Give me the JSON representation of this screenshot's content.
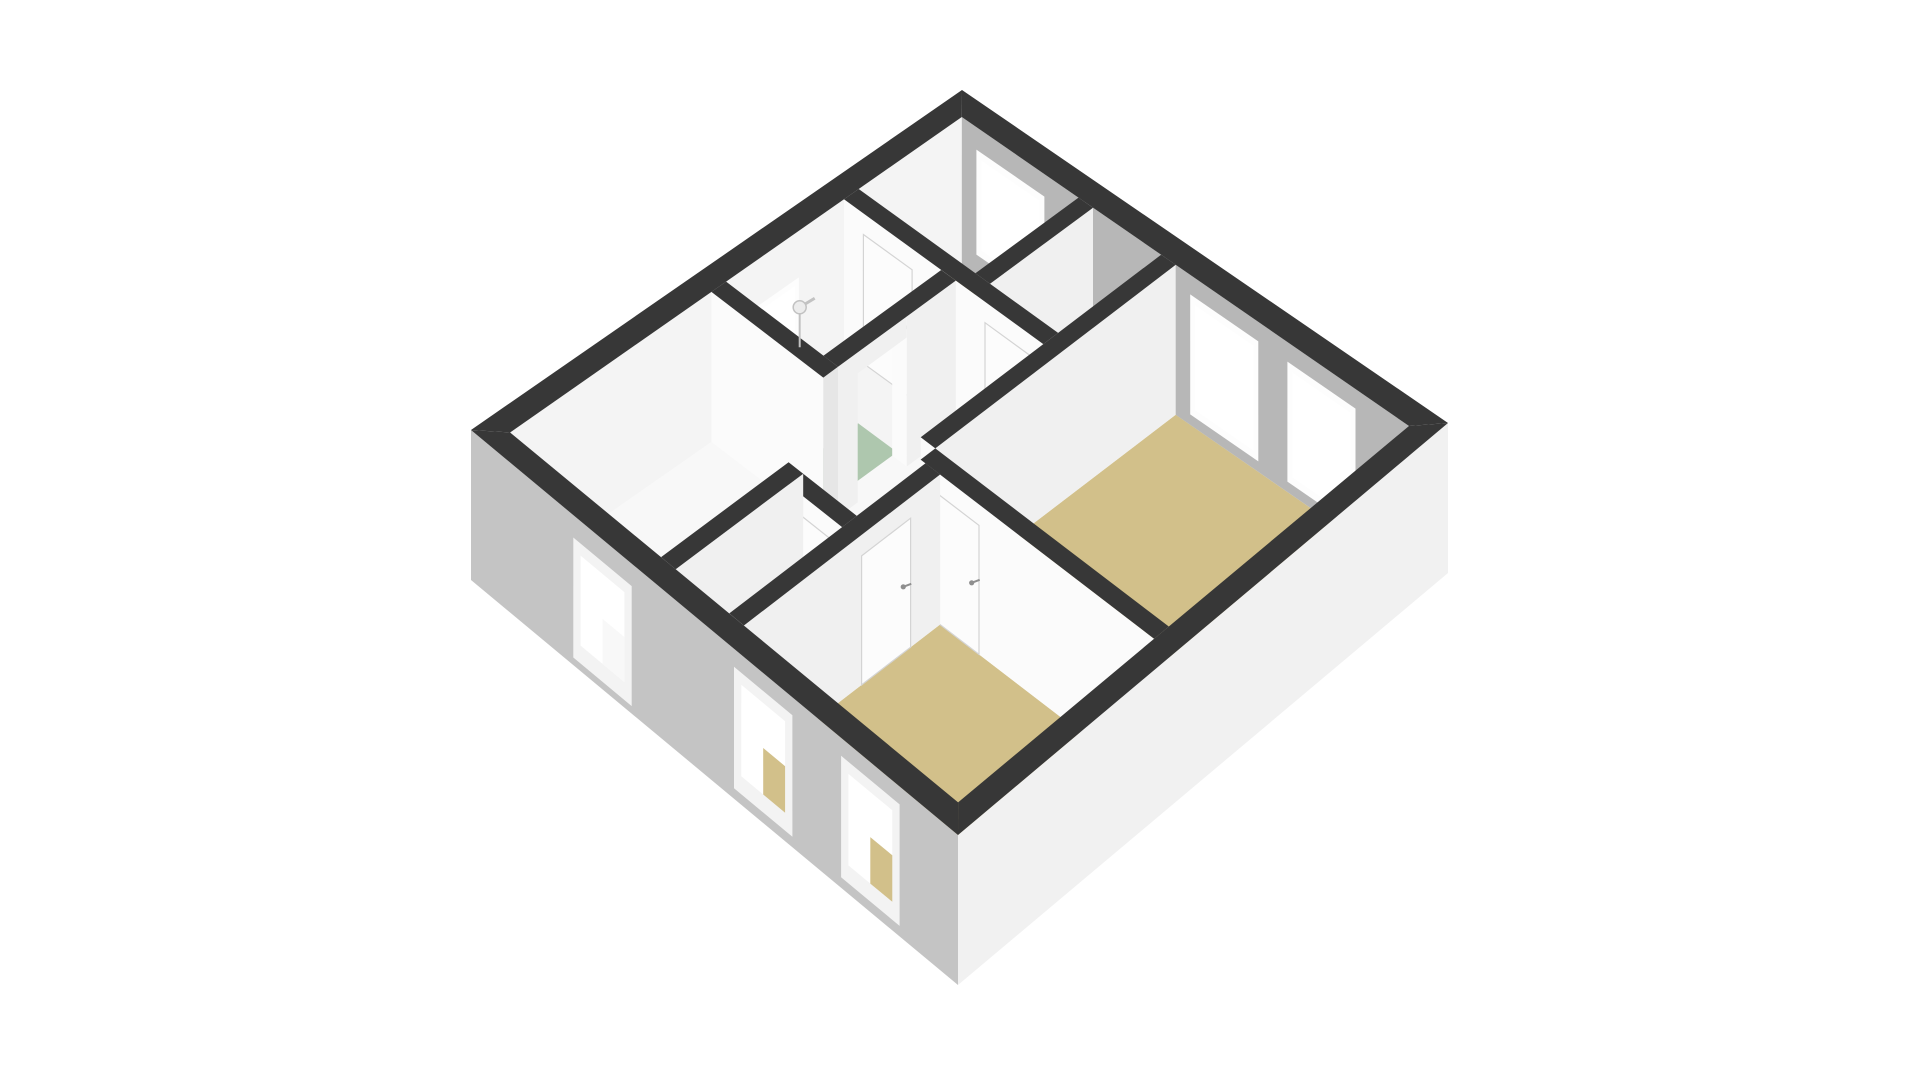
{
  "page": {
    "background": "#ffffff",
    "title": "3D floor plan view"
  },
  "scene": {
    "projection": {
      "corners": {
        "west": [
          471,
          430
        ],
        "north": [
          962,
          90
        ],
        "east": [
          1448,
          423
        ],
        "south": [
          958,
          835
        ]
      },
      "wallHeightPx": 150,
      "planSize": 100,
      "exteriorWallThickness": 4
    },
    "colors": {
      "wallCap": "#373737",
      "swFacade": "#c4c4c4",
      "seFacade": "#f1f1f1",
      "nwInnerFace": "#f4f4f4",
      "neInnerFace": "#b7b7b7",
      "hWallFace": "#fbfbfb",
      "vWallFace": "#f0f0f0",
      "endFace": "#e6e6e6",
      "floorWhite": "#f8f8f8",
      "floorTan": "#d2c08a",
      "floorGreen": "#aec7ae",
      "windowFrame": "#f3f3f3",
      "glass": "#ffffff",
      "doorPanel": "#fcfcfc",
      "doorSeam": "#d4d4d4",
      "handle": "#8f8f8f",
      "fixture": "#c2c2c2"
    },
    "rooms": [
      {
        "name": "floor-slab",
        "floor": "#f8f8f8",
        "rect": [
          4,
          4,
          96,
          96
        ]
      },
      {
        "name": "room-west",
        "floor": "#f8f8f8",
        "rect": [
          4,
          4,
          35,
          45
        ]
      },
      {
        "name": "bathroom",
        "floor": "#f4f4f4",
        "rect": [
          4,
          48,
          24,
          72
        ]
      },
      {
        "name": "bathroom-tile",
        "floor": "#aec7ae",
        "rect": [
          16,
          50,
          24,
          63
        ]
      },
      {
        "name": "bedroom-top",
        "floor": "#d2c08a",
        "rect": [
          4,
          75,
          28,
          96
        ]
      },
      {
        "name": "closet",
        "floor": "#f8f8f8",
        "rect": [
          31,
          75,
          45,
          96
        ]
      },
      {
        "name": "room-east",
        "floor": "#d2c08a",
        "rect": [
          48,
          47,
          96,
          96
        ]
      },
      {
        "name": "room-bottom",
        "floor": "#d2c08a",
        "rect": [
          52,
          4,
          96,
          44
        ]
      },
      {
        "name": "storage",
        "floor": "#f8f8f8",
        "rect": [
          38,
          4,
          49,
          27
        ]
      }
    ],
    "walls": [
      {
        "name": "bathroom-door-wall",
        "rect": [
          24,
          48,
          27,
          72
        ],
        "gap": [
          52,
          62
        ]
      },
      {
        "name": "west-bath-divider",
        "rect": [
          4,
          45,
          27,
          48
        ]
      },
      {
        "name": "hall-north-wall",
        "rect": [
          4,
          72,
          45,
          75
        ],
        "doors": [
          {
            "a1": 8,
            "a2": 18,
            "handle": true
          },
          {
            "a1": 33,
            "a2": 43,
            "handle": false
          }
        ]
      },
      {
        "name": "top-closet-divider",
        "rect": [
          28,
          75,
          31,
          96
        ]
      },
      {
        "name": "east-nw-wall",
        "rect": [
          45,
          47,
          48,
          96
        ]
      },
      {
        "name": "east-sw-wall",
        "rect": [
          48,
          44,
          96,
          47
        ],
        "doors": [
          {
            "a1": 50,
            "a2": 60,
            "handle": true
          }
        ]
      },
      {
        "name": "bottom-nw-wall",
        "rect": [
          49,
          4,
          52,
          44
        ],
        "doors": [
          {
            "a1": 28,
            "a2": 38,
            "handle": true
          }
        ]
      },
      {
        "name": "west-se-wall",
        "rect": [
          35,
          4,
          38,
          30
        ]
      },
      {
        "name": "storage-wall",
        "rect": [
          38,
          27,
          49,
          30
        ],
        "doors": [
          {
            "a1": 40,
            "a2": 47,
            "handle": false
          }
        ]
      }
    ],
    "windows": {
      "nw": [
        {
          "t1": 53,
          "t2": 62,
          "v1": 0.35,
          "v2": 0.66
        }
      ],
      "ne": [
        {
          "t1": 8,
          "t2": 20,
          "v1": 0.2,
          "v2": 0.8
        },
        {
          "t1": 52,
          "t2": 64,
          "v1": 0.18,
          "v2": 0.88
        },
        {
          "t1": 72,
          "t2": 84,
          "v1": 0.18,
          "v2": 0.88
        }
      ],
      "sw": [
        {
          "t1": 21,
          "t2": 33,
          "v1": 0.15,
          "v2": 0.95,
          "through": "#f8f8f8"
        },
        {
          "t1": 54,
          "t2": 66,
          "v1": 0.12,
          "v2": 0.93,
          "through": "#d2c08a"
        },
        {
          "t1": 76,
          "t2": 88,
          "v1": 0.12,
          "v2": 0.93,
          "through": "#d2c08a"
        }
      ]
    },
    "fixtures": [
      {
        "type": "shower-head",
        "plan": [
          6,
          61
        ],
        "v": 0.42
      }
    ]
  }
}
